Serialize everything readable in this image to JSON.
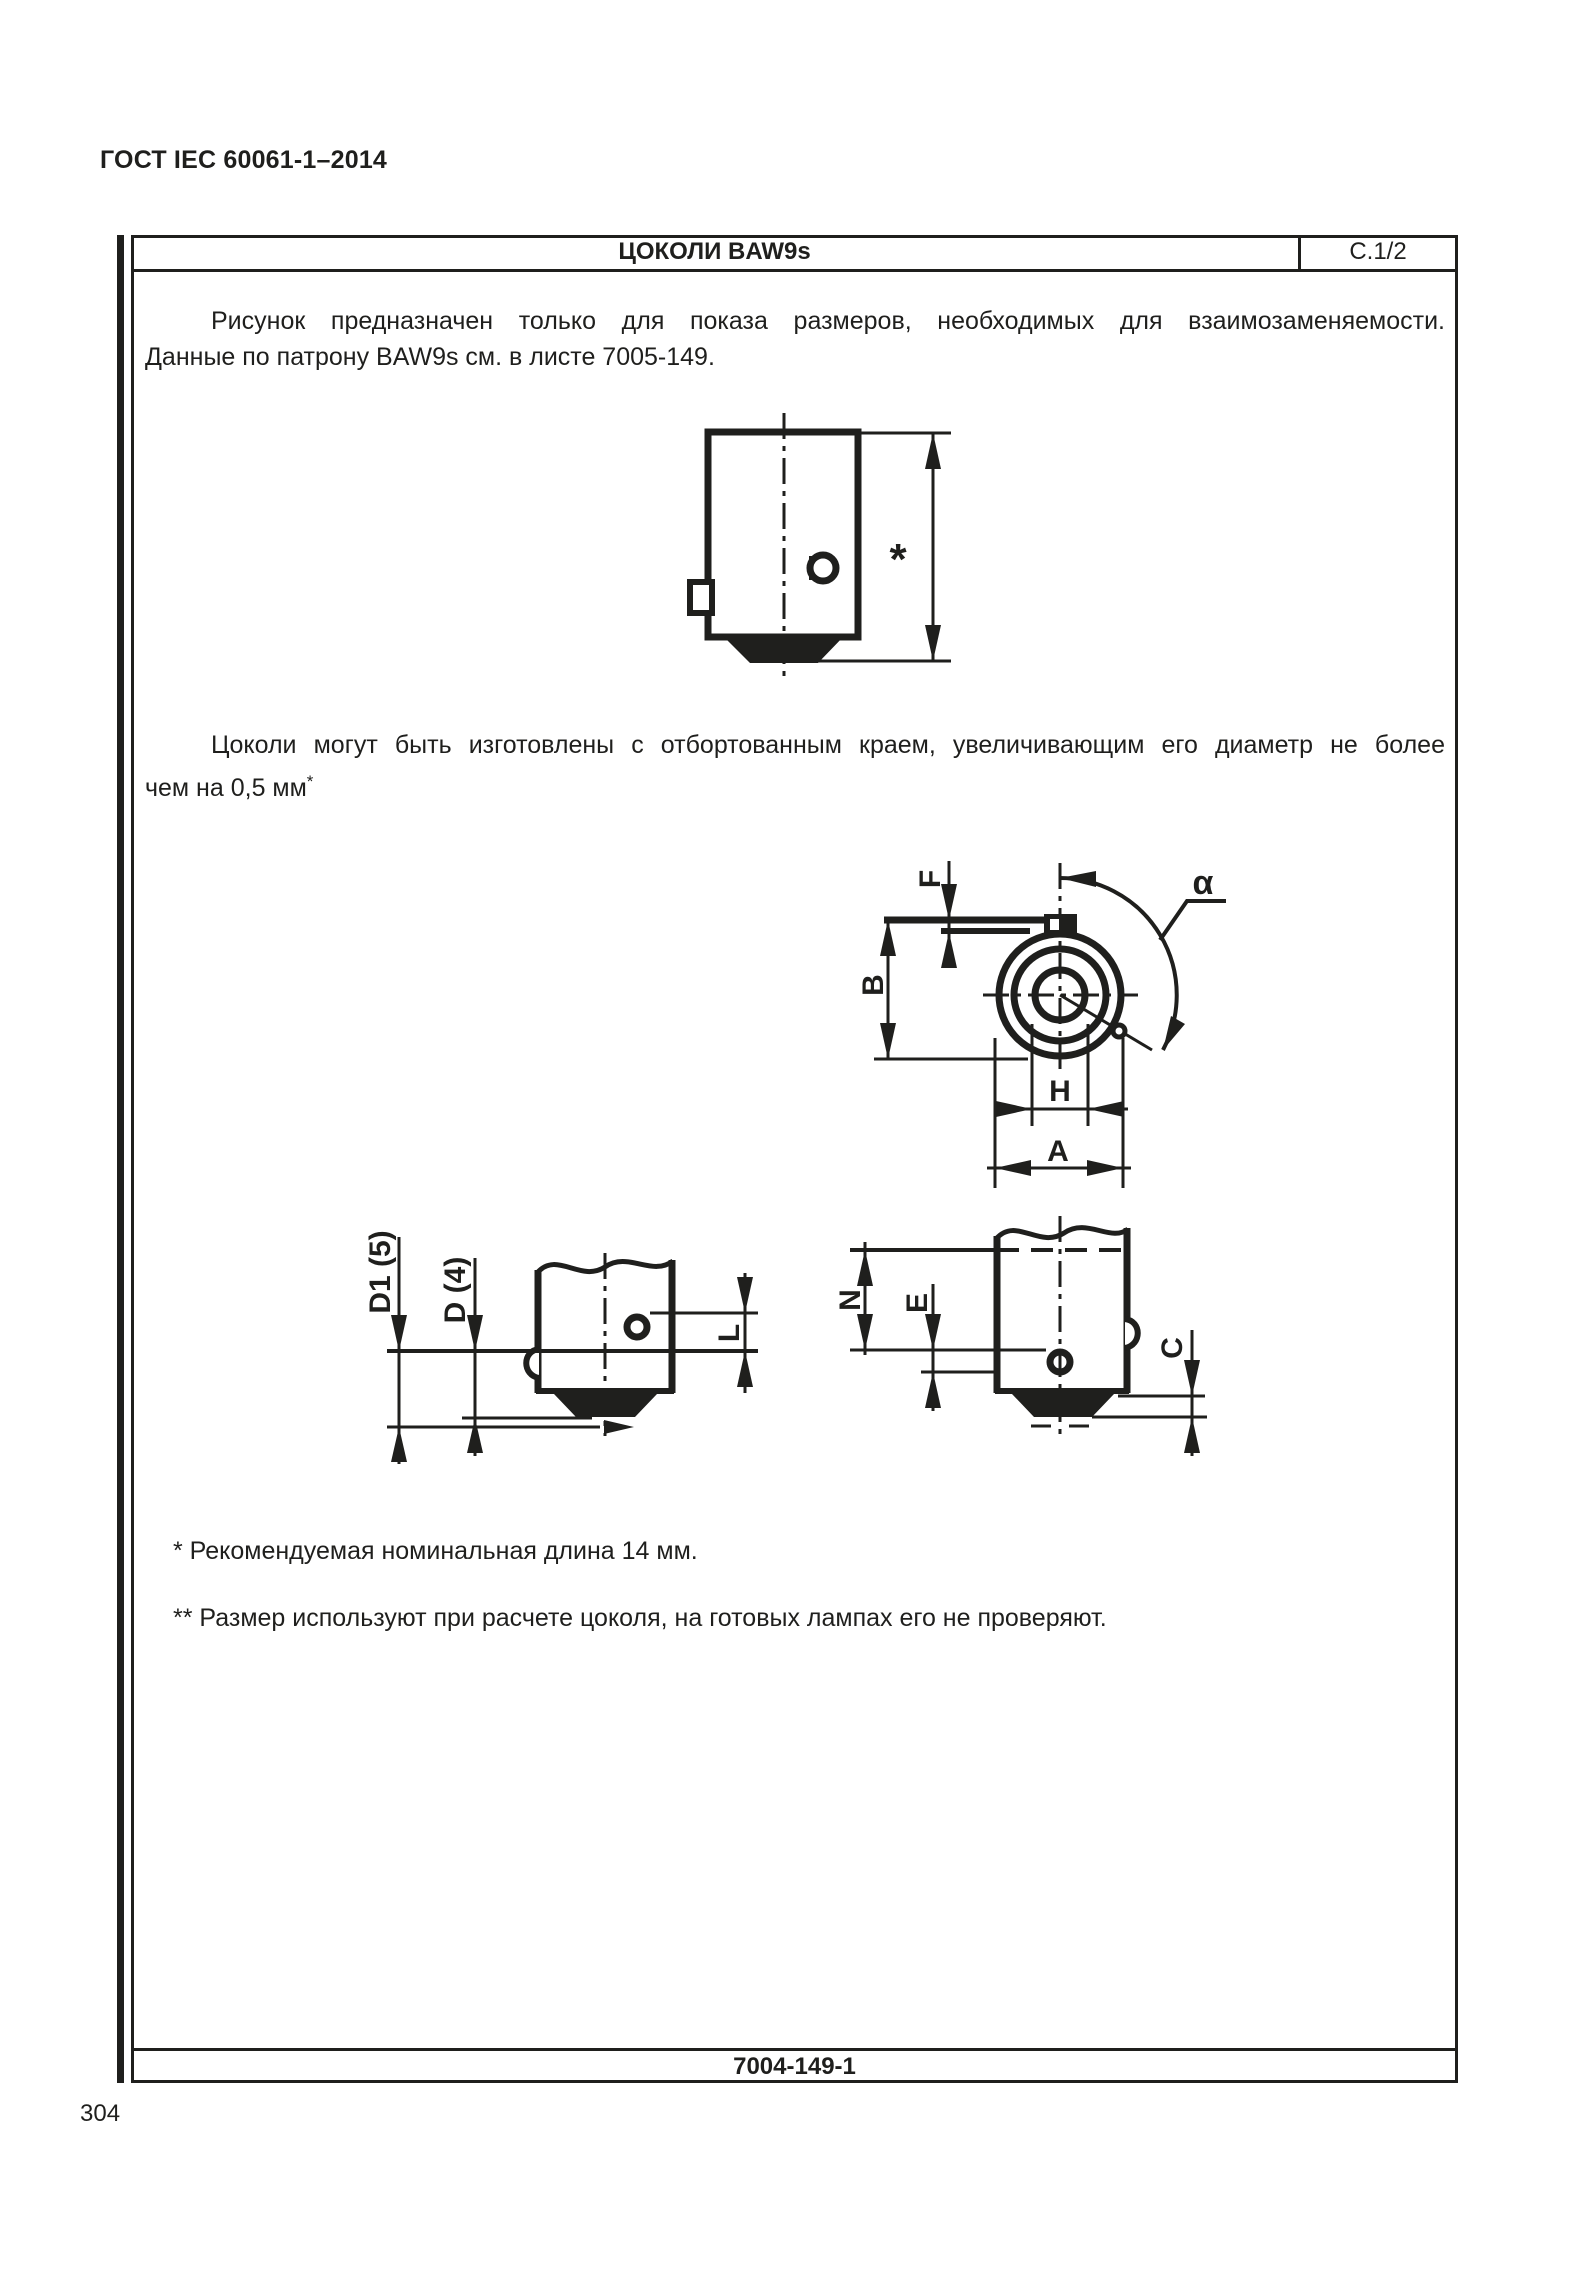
{
  "page": {
    "standard_header": "ГОСТ IEC 60061-1–2014",
    "page_number": "304"
  },
  "sheet": {
    "title": "ЦОКОЛИ BAW9s",
    "sheet_code": "С.1/2",
    "doc_number": "7004-149-1",
    "intro": {
      "line1": "Рисунок предназначен только для показа размеров, необходимых для взаимозаменяемости.",
      "line2": "Данные по патрону BAW9s см. в листе 7005-149."
    },
    "flange_note": {
      "line1": "Цоколи могут быть изготовлены с отбортованным краем, увеличивающим его диаметр не более",
      "line2": "чем на 0,5 мм",
      "superscript": "*"
    },
    "footnotes": {
      "first": "* Рекомендуемая номинальная длина 14 мм.",
      "second": "** Размер используют при расчете цоколя, на готовых лампах его не проверяют."
    },
    "dimensions": {
      "overall_length_mark": "*",
      "f": "F",
      "alpha": "α",
      "b": "B",
      "h": "H",
      "a": "A",
      "d1": "D1 (5)",
      "d": "D (4)",
      "l": "L",
      "n": "N",
      "e": "E",
      "c": "C"
    }
  },
  "colors": {
    "ink": "#1f1f1d",
    "paper": "#ffffff"
  }
}
